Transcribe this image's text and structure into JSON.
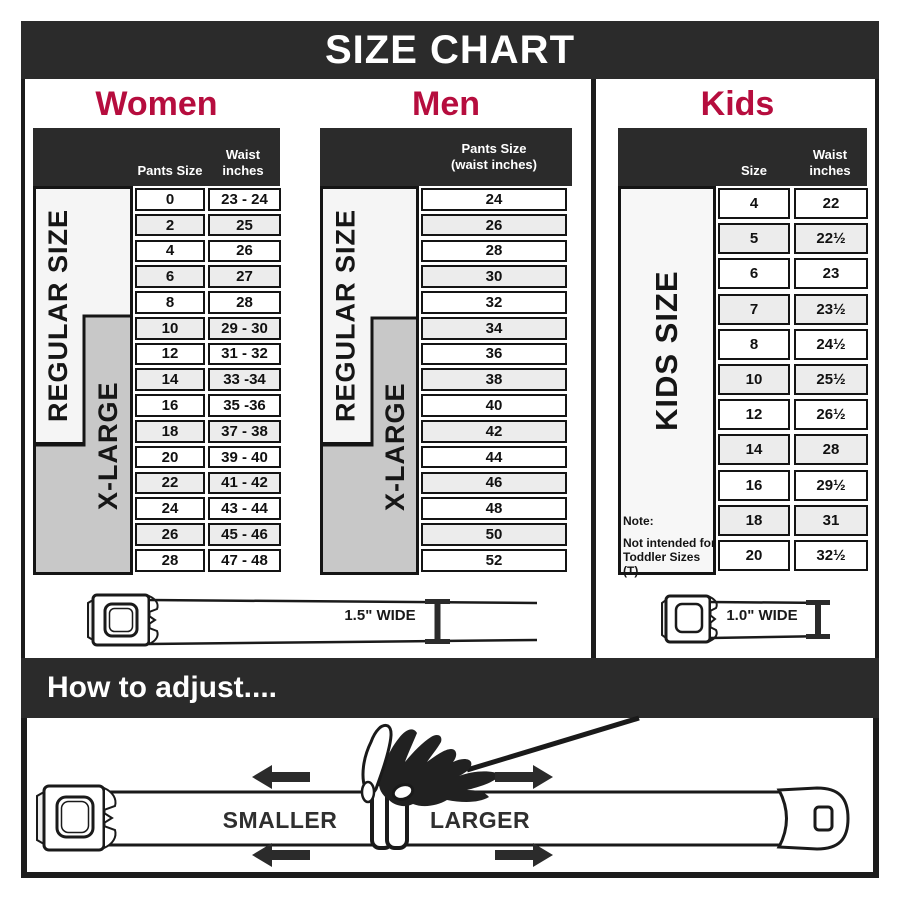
{
  "title": "SIZE CHART",
  "colors": {
    "dark_bar": "#2b2b2b",
    "accent_red": "#b60d3e",
    "row_alt": "#ececec",
    "xlarge_gray": "#c8c8c8"
  },
  "women": {
    "heading": "Women",
    "col1": "Pants Size",
    "col2": "Waist inches",
    "regular_label": "REGULAR SIZE",
    "xlarge_label": "X-LARGE",
    "rows": [
      [
        "0",
        "23 - 24"
      ],
      [
        "2",
        "25"
      ],
      [
        "4",
        "26"
      ],
      [
        "6",
        "27"
      ],
      [
        "8",
        "28"
      ],
      [
        "10",
        "29 - 30"
      ],
      [
        "12",
        "31 - 32"
      ],
      [
        "14",
        "33 -34"
      ],
      [
        "16",
        "35 -36"
      ],
      [
        "18",
        "37 - 38"
      ],
      [
        "20",
        "39 - 40"
      ],
      [
        "22",
        "41 - 42"
      ],
      [
        "24",
        "43 - 44"
      ],
      [
        "26",
        "45 - 46"
      ],
      [
        "28",
        "47 - 48"
      ]
    ]
  },
  "men": {
    "heading": "Men",
    "col": "Pants Size (waist inches)",
    "regular_label": "REGULAR SIZE",
    "xlarge_label": "X-LARGE",
    "rows": [
      [
        "24"
      ],
      [
        "26"
      ],
      [
        "28"
      ],
      [
        "30"
      ],
      [
        "32"
      ],
      [
        "34"
      ],
      [
        "36"
      ],
      [
        "38"
      ],
      [
        "40"
      ],
      [
        "42"
      ],
      [
        "44"
      ],
      [
        "46"
      ],
      [
        "48"
      ],
      [
        "50"
      ],
      [
        "52"
      ]
    ]
  },
  "kids": {
    "heading": "Kids",
    "col1": "Size",
    "col2": "Waist inches",
    "side_label": "KIDS SIZE",
    "note_title": "Note:",
    "note_line1": "Not intended for",
    "note_line2": "Toddler Sizes (T)",
    "rows": [
      [
        "4",
        "22"
      ],
      [
        "5",
        "22½"
      ],
      [
        "6",
        "23"
      ],
      [
        "7",
        "23½"
      ],
      [
        "8",
        "24½"
      ],
      [
        "10",
        "25½"
      ],
      [
        "12",
        "26½"
      ],
      [
        "14",
        "28"
      ],
      [
        "16",
        "29½"
      ],
      [
        "18",
        "31"
      ],
      [
        "20",
        "32½"
      ]
    ]
  },
  "belts": {
    "adult_width": "1.5\" WIDE",
    "kids_width": "1.0\" WIDE"
  },
  "adjust": {
    "heading": "How to adjust....",
    "smaller": "SMALLER",
    "larger": "LARGER"
  }
}
